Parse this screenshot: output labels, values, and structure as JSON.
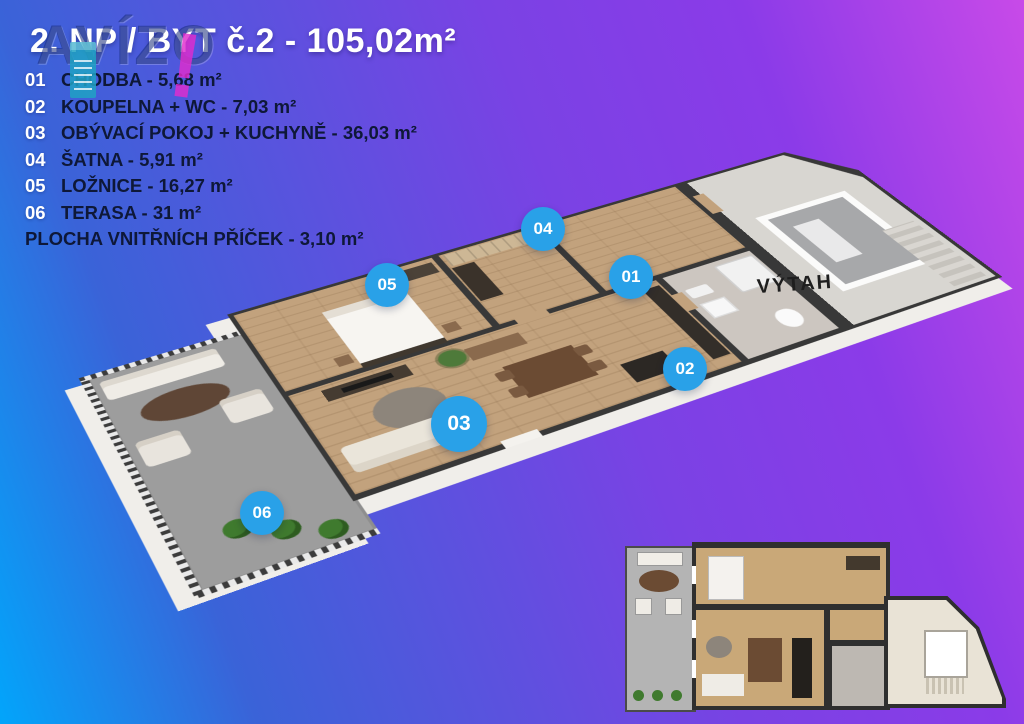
{
  "title": "2. NP / BYT č.2 - 105,02m²",
  "watermark": {
    "text": "AVÍZO",
    "mark": "!"
  },
  "legend": {
    "items": [
      {
        "num": "01",
        "label": "CHODBA - 5,68 m²"
      },
      {
        "num": "02",
        "label": "KOUPELNA + WC - 7,03 m²"
      },
      {
        "num": "03",
        "label": "OBÝVACÍ POKOJ + KUCHYNĚ - 36,03 m²"
      },
      {
        "num": "04",
        "label": "ŠATNA - 5,91 m²"
      },
      {
        "num": "05",
        "label": "LOŽNICE - 16,27 m²"
      },
      {
        "num": "06",
        "label": "TERASA - 31 m²"
      }
    ],
    "footer": "PLOCHA VNITŘNÍCH PŘÍČEK - 3,10 m²"
  },
  "plan": {
    "elevator_label": "VÝTAH",
    "elevator_label_pos": {
      "x": 795,
      "y": 285
    },
    "markers": [
      {
        "id": "01",
        "x": 631,
        "y": 277
      },
      {
        "id": "02",
        "x": 685,
        "y": 369
      },
      {
        "id": "03",
        "x": 459,
        "y": 424
      },
      {
        "id": "04",
        "x": 543,
        "y": 229
      },
      {
        "id": "05",
        "x": 387,
        "y": 285
      },
      {
        "id": "06",
        "x": 262,
        "y": 513
      }
    ]
  },
  "colors": {
    "marker_blue": "#29a1e8",
    "legend_text": "#0e1838",
    "gradient_blue": "#02a5fb",
    "gradient_purple": "#c84ae8",
    "watermark_navy": "#182b7a",
    "watermark_magenta": "#e02cce",
    "watermark_teal": "#20a2c3",
    "wall_dark": "#383838",
    "wood_floor": "#c2a27d",
    "terrace_gray": "#9d9d9d"
  }
}
